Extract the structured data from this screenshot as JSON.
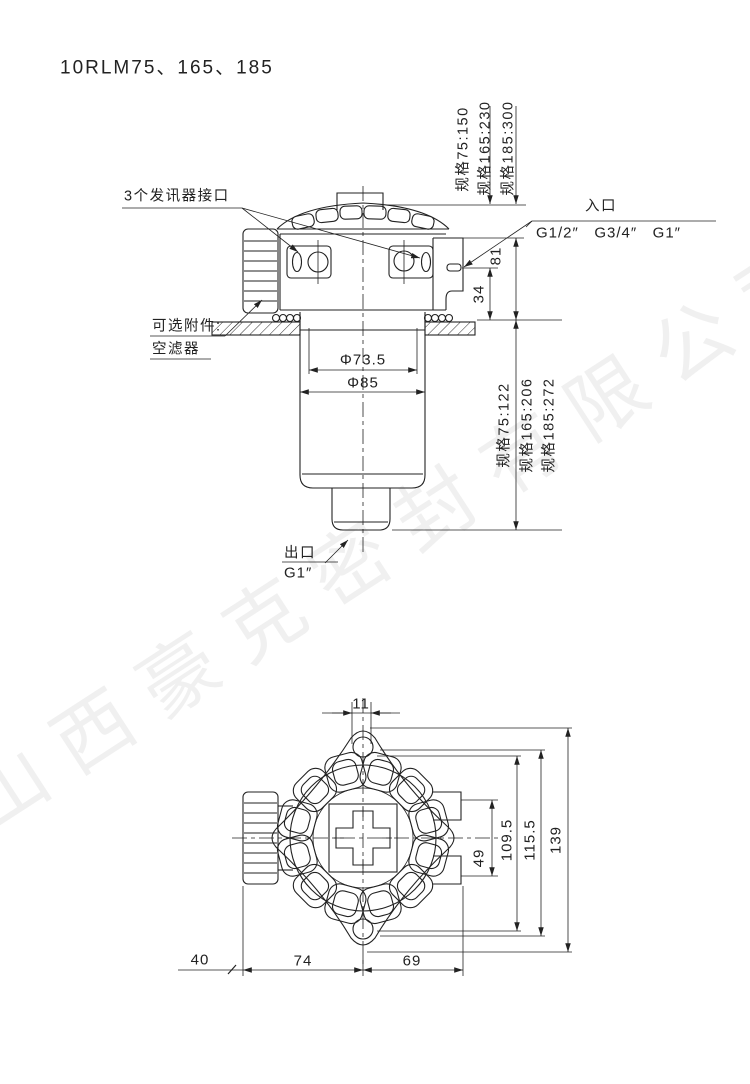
{
  "title": "10RLM75、165、185",
  "watermark": "山西豪克密封有限公司",
  "side_view": {
    "sensor_ports_label": "3个发讯器接口",
    "optional_accessory": {
      "line1": "可选附件:",
      "line2": "空滤器"
    },
    "inlet": {
      "label": "入口",
      "threads": "G1/2″   G3/4″   G1″"
    },
    "outlet": {
      "label": "出口",
      "thread": "G1″"
    },
    "dims": {
      "inner_diameter": "Φ73.5",
      "outer_diameter": "Φ85",
      "inlet_height": "81",
      "plate_to_port": "34",
      "specs_height_top": [
        "规格75:150",
        "规格165:230",
        "规格185:300"
      ],
      "specs_height_bowl": [
        "规格75:122",
        "规格165:206",
        "规格185:272"
      ]
    }
  },
  "bottom_view": {
    "dims": {
      "key_width": "11",
      "bracket_span": "49",
      "across_1": "109.5",
      "across_2": "115.5",
      "diagonal": "139",
      "offset_left": "40",
      "span_left": "74",
      "span_right": "69"
    }
  }
}
